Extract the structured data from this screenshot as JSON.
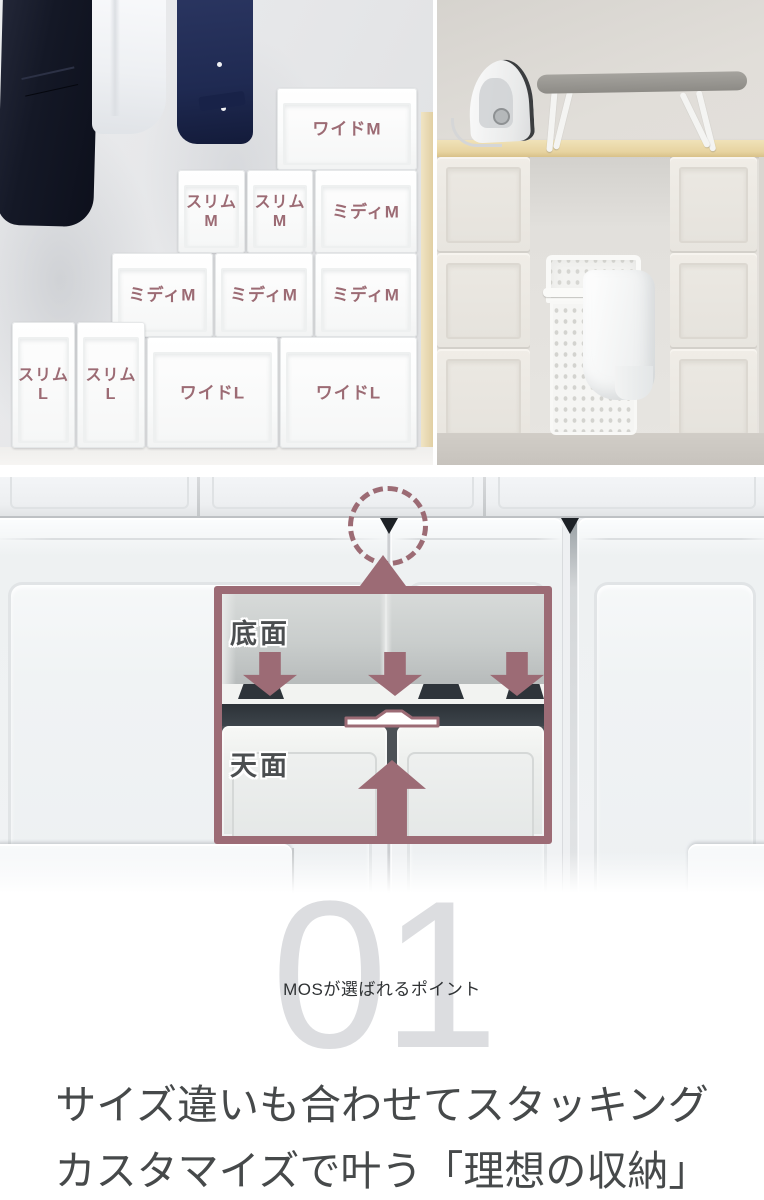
{
  "accent_color": "#9c6b74",
  "left_photo": {
    "boxes": [
      {
        "line1": "ワイドM",
        "line2": ""
      },
      {
        "line1": "スリム",
        "line2": "M"
      },
      {
        "line1": "スリム",
        "line2": "M"
      },
      {
        "line1": "ミディM",
        "line2": ""
      },
      {
        "line1": "ミディM",
        "line2": ""
      },
      {
        "line1": "ミディM",
        "line2": ""
      },
      {
        "line1": "ミディM",
        "line2": ""
      },
      {
        "line1": "スリム",
        "line2": "L"
      },
      {
        "line1": "スリム",
        "line2": "L"
      },
      {
        "line1": "ワイドL",
        "line2": ""
      },
      {
        "line1": "ワイドL",
        "line2": ""
      }
    ]
  },
  "diagram": {
    "bottom_face_label": "底面",
    "top_face_label": "天面"
  },
  "point": {
    "number": "01",
    "number_color": "#dcdde0",
    "tagline": "MOSが選ばれるポイント",
    "heading_line1": "サイズ違いも合わせてスタッキング",
    "heading_line2": "カスタマイズで叶う「理想の収納」",
    "heading_color": "#46494a"
  }
}
